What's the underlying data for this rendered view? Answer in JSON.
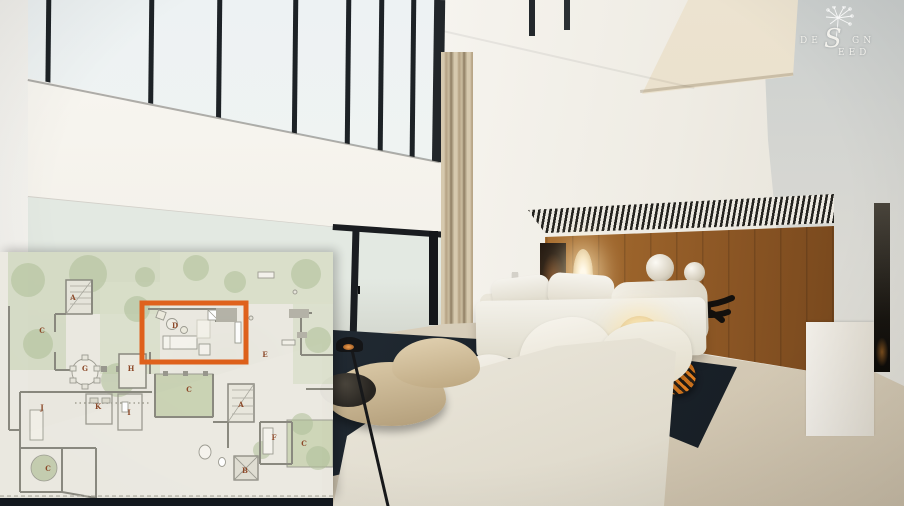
{
  "brand": {
    "name": "DESIGN SEED",
    "word1_prefix": "DE",
    "shared_letter": "S",
    "word1_suffix": "GN",
    "word2_suffix": "EED",
    "icon": "dandelion-icon",
    "text_color": "#f2f1ec"
  },
  "floor_plan": {
    "type": "architectural-plan-overlay",
    "paper_color": "#ebe9e1",
    "garden_color": "#ced6bc",
    "wall_color": "#87867c",
    "label_color": "#8a4423",
    "highlight": {
      "room": "D",
      "color": "#e05e17",
      "x": 142,
      "y": 51,
      "w": 104,
      "h": 59
    },
    "labels": [
      {
        "t": "A",
        "x": 73,
        "y": 48
      },
      {
        "t": "C",
        "x": 42,
        "y": 81
      },
      {
        "t": "D",
        "x": 175,
        "y": 76
      },
      {
        "t": "E",
        "x": 265,
        "y": 105
      },
      {
        "t": "G",
        "x": 85,
        "y": 119
      },
      {
        "t": "H",
        "x": 131,
        "y": 119
      },
      {
        "t": "C",
        "x": 189,
        "y": 140
      },
      {
        "t": "A",
        "x": 241,
        "y": 155
      },
      {
        "t": "J",
        "x": 42,
        "y": 158
      },
      {
        "t": "K",
        "x": 98,
        "y": 157
      },
      {
        "t": "I",
        "x": 129,
        "y": 163
      },
      {
        "t": "F",
        "x": 274,
        "y": 188
      },
      {
        "t": "C",
        "x": 304,
        "y": 194
      },
      {
        "t": "C",
        "x": 48,
        "y": 219
      },
      {
        "t": "B",
        "x": 245,
        "y": 221
      }
    ]
  },
  "scene": {
    "palette": {
      "wood_wall": "#8a5524",
      "rug": "#1f272f",
      "sofa": "#efede5",
      "floor": "#d8cfbe",
      "curtain": "#c4b596",
      "throw_accent": "#df7d20",
      "window_frame": "#1d2226",
      "foliage": "#7a9a62"
    },
    "objects": [
      "clerestory-windows",
      "glass-sliding-door",
      "curtains",
      "wood-panel-wall",
      "artwork",
      "sculptural-floor-lamp",
      "driftwood-console",
      "sphere-vases",
      "shell-lamp",
      "daybed",
      "sectional-sofa",
      "ottomans",
      "round-tray-table",
      "reading-floor-lamp",
      "area-rug",
      "throw-blanket",
      "mezzanine"
    ]
  }
}
